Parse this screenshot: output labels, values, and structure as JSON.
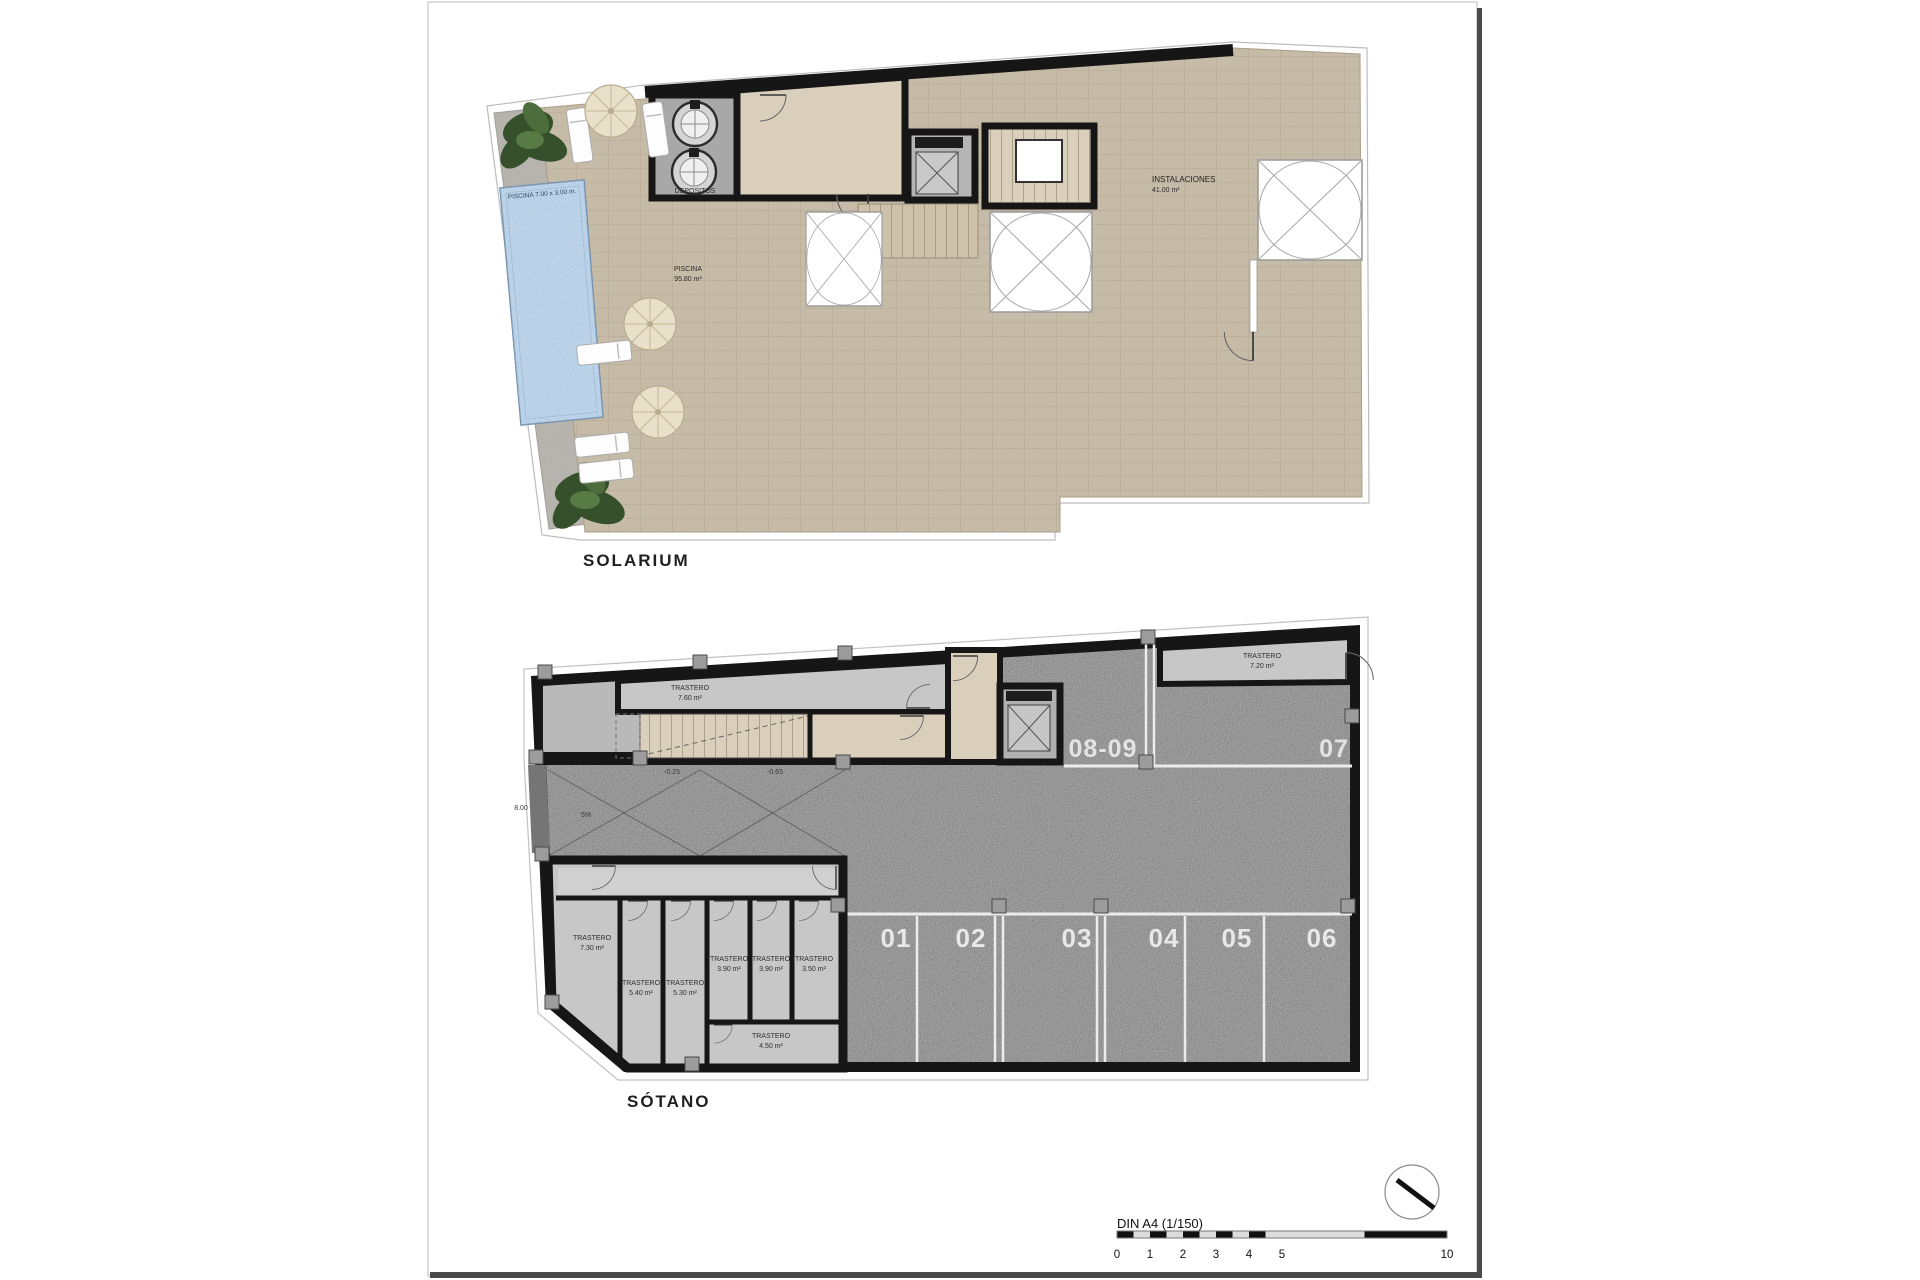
{
  "document": {
    "plans": {
      "solarium": {
        "title": "SOLARIUM",
        "pool_dim": "PISCINA 7.00 x 3.00 m.",
        "pool_name": "PISCINA",
        "pool_area": "95.80 m²",
        "tanks_room": "DEPOSITOS",
        "instal_name": "INSTALACIONES",
        "instal_area": "41.00 m²"
      },
      "sotano": {
        "title": "SÓTANO",
        "parking": {
          "top_left": "08-09",
          "top_right": "07",
          "bottom": [
            "01",
            "02",
            "03",
            "04",
            "05",
            "06"
          ]
        },
        "storerooms": {
          "s760": {
            "name": "TRASTERO",
            "area": "7.60 m²"
          },
          "s720": {
            "name": "TRASTERO",
            "area": "7.20 m²"
          },
          "s730": {
            "name": "TRASTERO",
            "area": "7.30 m²"
          },
          "s540": {
            "name": "TRASTERO",
            "area": "5.40 m²"
          },
          "s530": {
            "name": "TRASTERO",
            "area": "5.30 m²"
          },
          "s390a": {
            "name": "TRASTERO",
            "area": "3.90 m²"
          },
          "s390b": {
            "name": "TRASTERO",
            "area": "3.90 m²"
          },
          "s350": {
            "name": "TRASTERO",
            "area": "3.50 m²"
          },
          "s450": {
            "name": "TRASTERO",
            "area": "4.50 m²"
          }
        },
        "annotations": {
          "ramp_length": "8.00",
          "ramp_slope": "5%",
          "level_upper": "-0.25",
          "level_lower": "-0.65"
        }
      }
    },
    "footer": {
      "scale_title": "DIN A4 (1/150)",
      "scale_ticks": [
        "0",
        "1",
        "2",
        "3",
        "4",
        "5",
        "10"
      ]
    },
    "colors": {
      "terrace": "#c8bba3",
      "pool": "#a9c6e2",
      "asphalt": "#757575",
      "wall": "#161616",
      "concrete": "#b9b9b9",
      "storeroom": "#c7c7c7",
      "lobby": "#d9cfba"
    }
  }
}
